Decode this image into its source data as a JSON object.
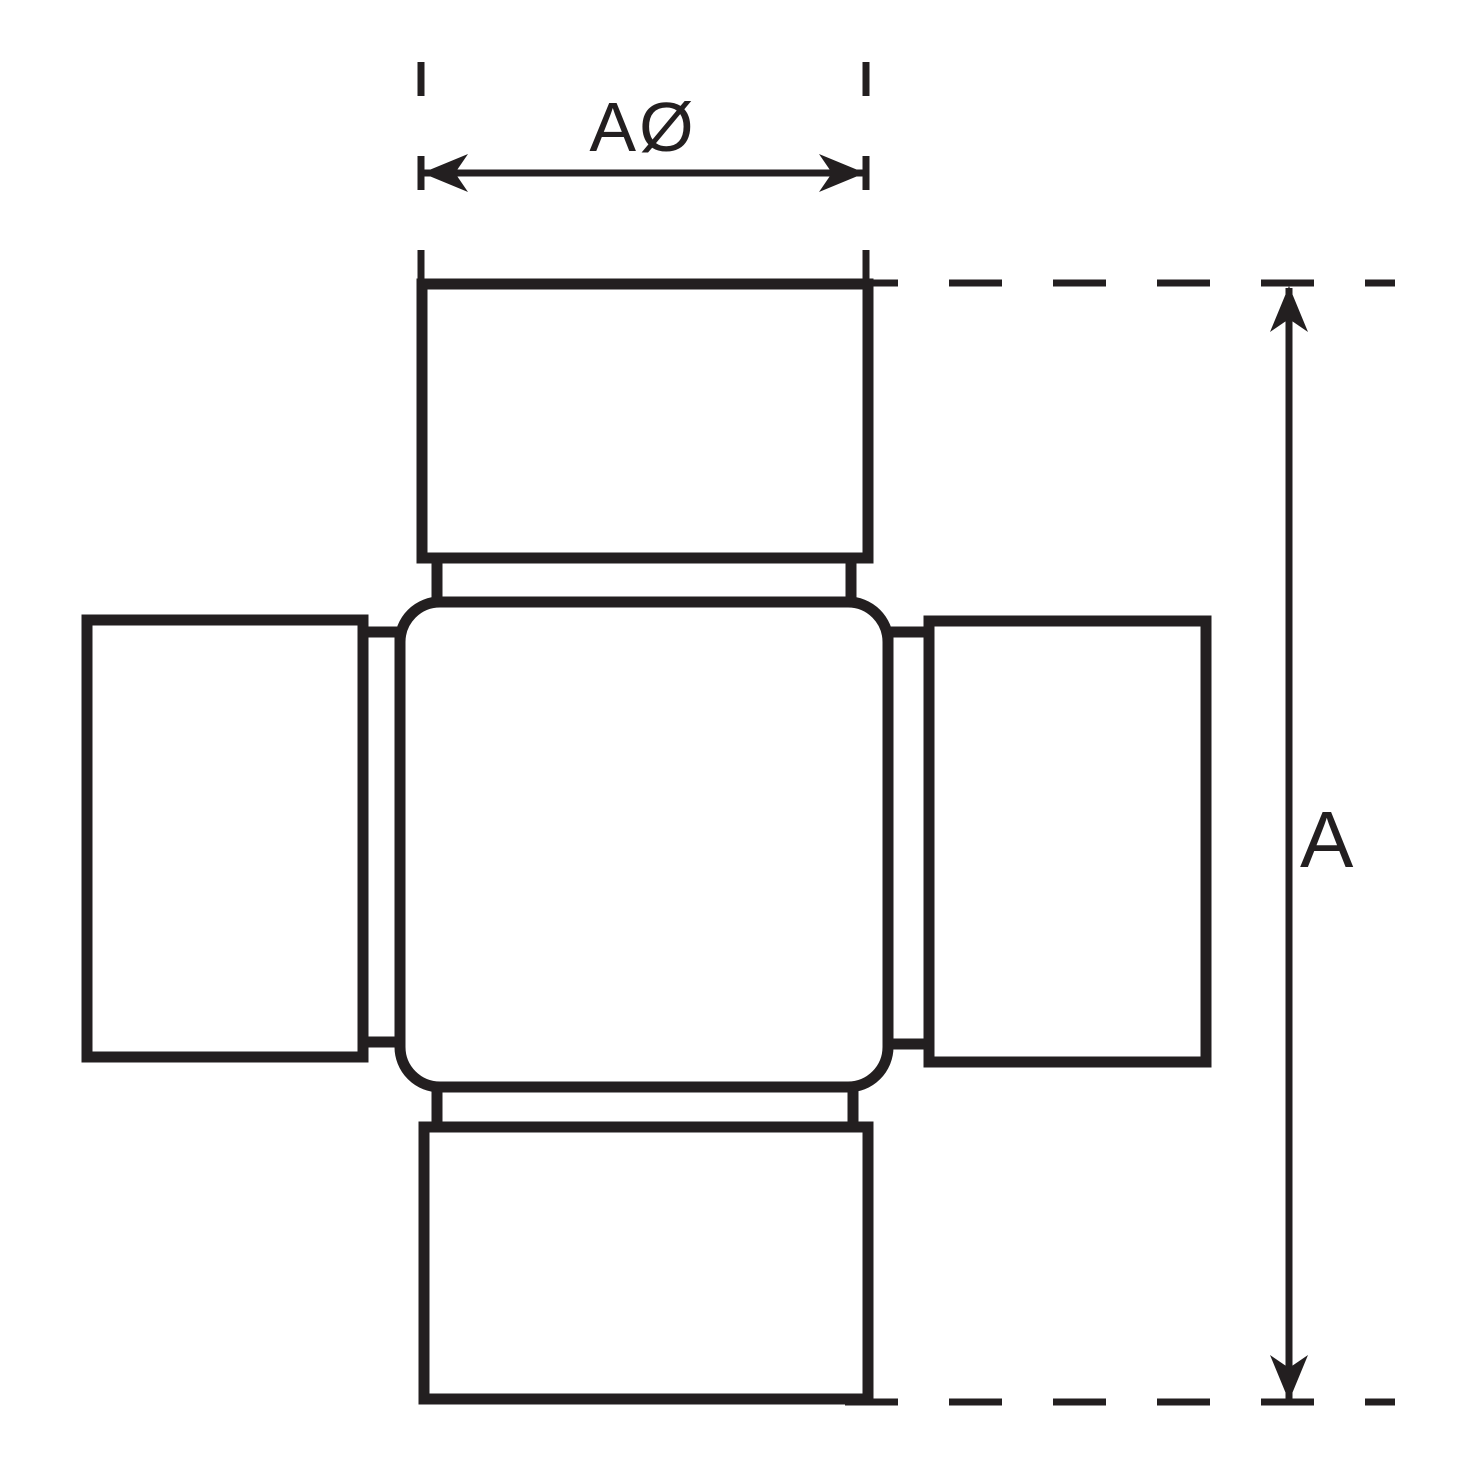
{
  "drawing": {
    "dimensions": {
      "width_label": "AØ",
      "height_label": "A"
    },
    "colors": {
      "line": "#231F20",
      "background": "#FFFFFF"
    }
  }
}
